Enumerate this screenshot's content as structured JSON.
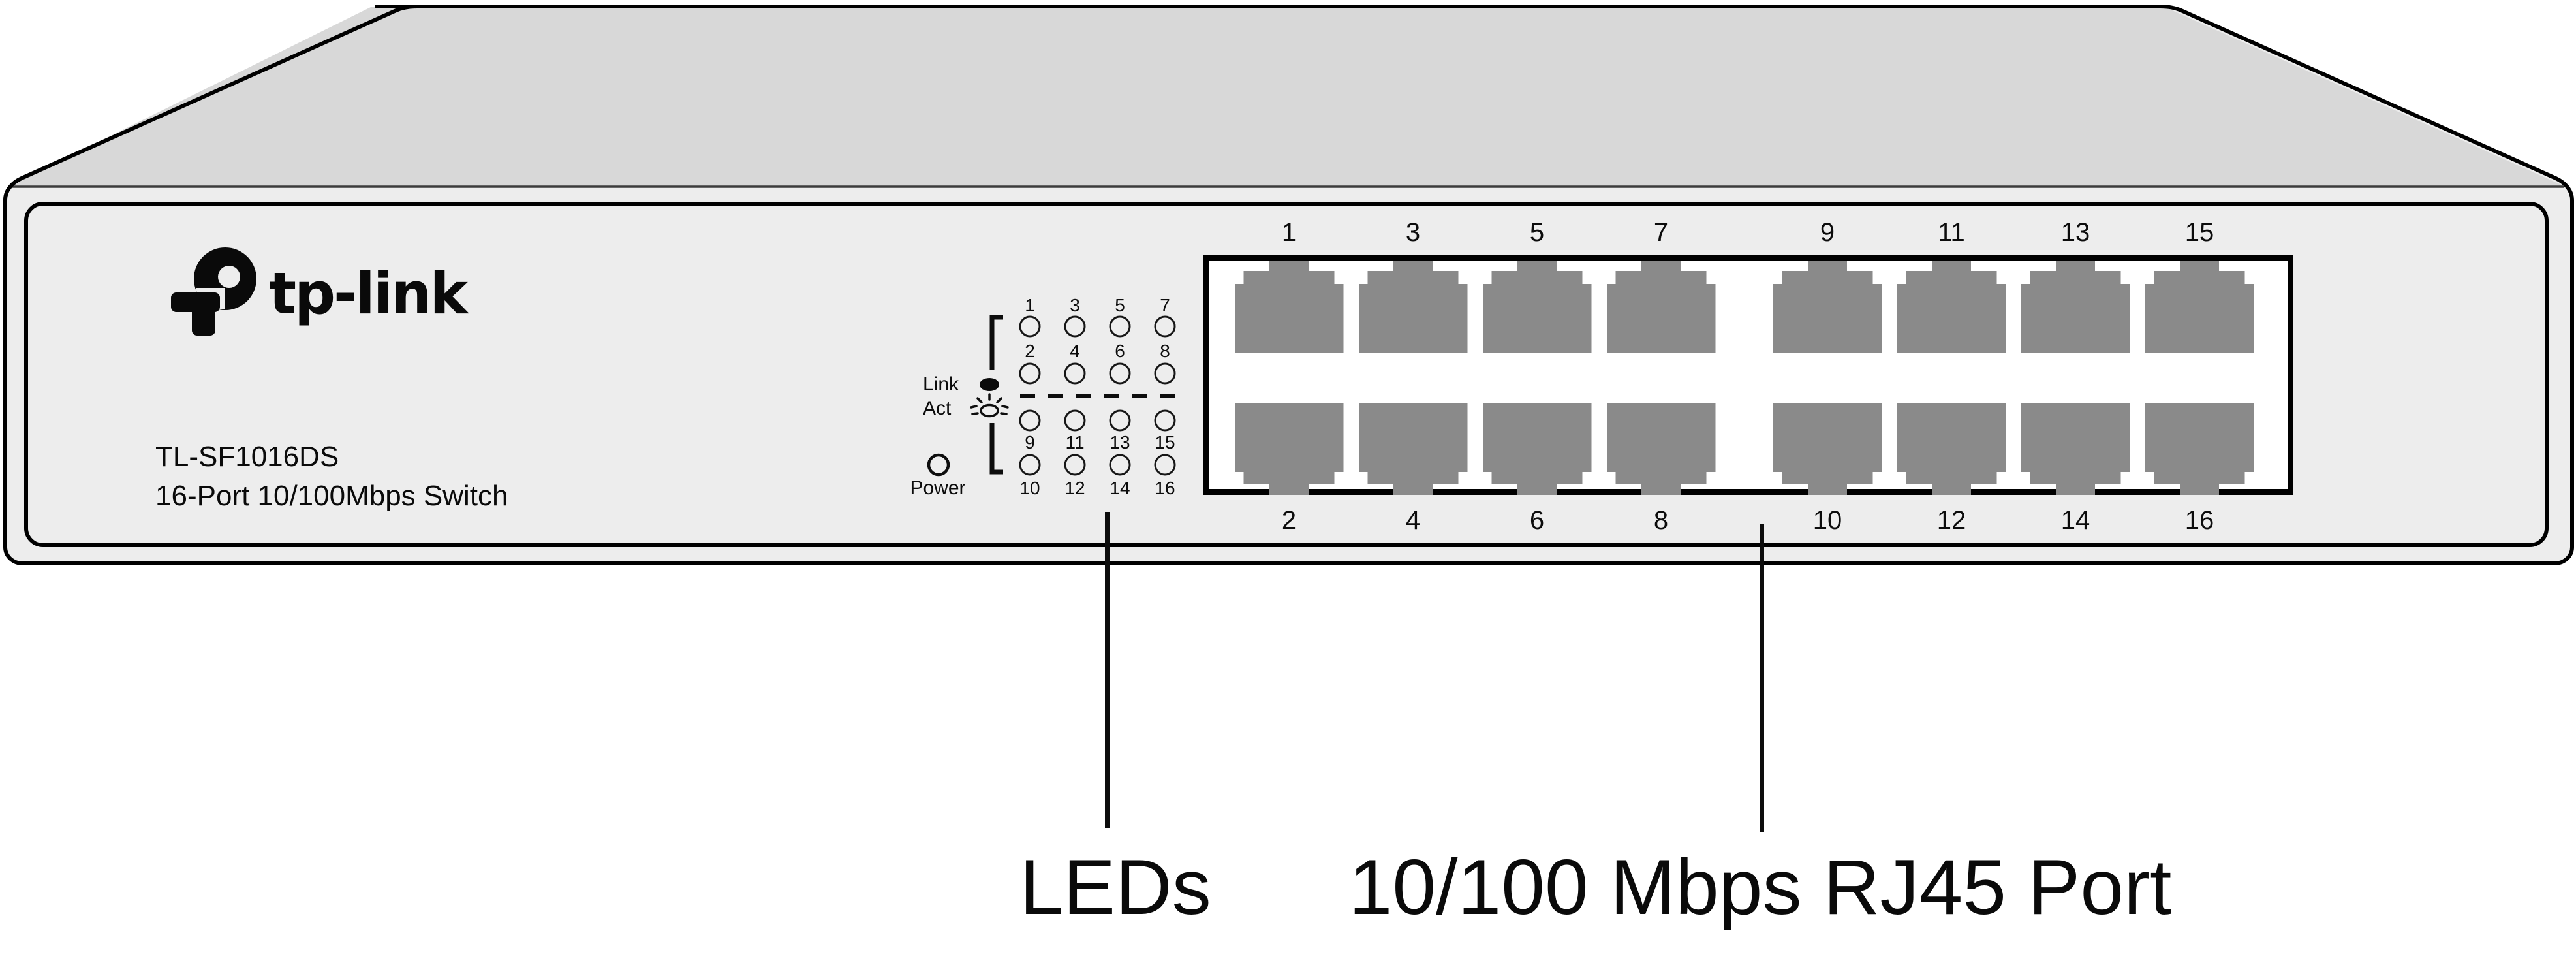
{
  "device": {
    "brand": "tp-link",
    "model": "TL-SF1016DS",
    "description": "16-Port 10/100Mbps Switch"
  },
  "led_panel": {
    "link_label": "Link",
    "act_label": "Act",
    "power_label": "Power",
    "upper_group_row1_numbers": [
      "1",
      "3",
      "5",
      "7"
    ],
    "upper_group_row2_numbers": [
      "2",
      "4",
      "6",
      "8"
    ],
    "lower_group_row1_numbers": [
      "9",
      "11",
      "13",
      "15"
    ],
    "lower_group_row2_numbers": [
      "10",
      "12",
      "14",
      "16"
    ]
  },
  "port_panel": {
    "top_row_numbers": [
      "1",
      "3",
      "5",
      "7",
      "9",
      "11",
      "13",
      "15"
    ],
    "bottom_row_numbers": [
      "2",
      "4",
      "6",
      "8",
      "10",
      "12",
      "14",
      "16"
    ]
  },
  "callouts": {
    "leds_label": "LEDs",
    "rj45_label": "10/100 Mbps RJ45 Port"
  },
  "colors": {
    "top_face": "#d8d8d8",
    "front_face": "#ededed",
    "port_gray": "#8a8a8a",
    "outline": "#000000",
    "panel_white": "#ffffff"
  }
}
